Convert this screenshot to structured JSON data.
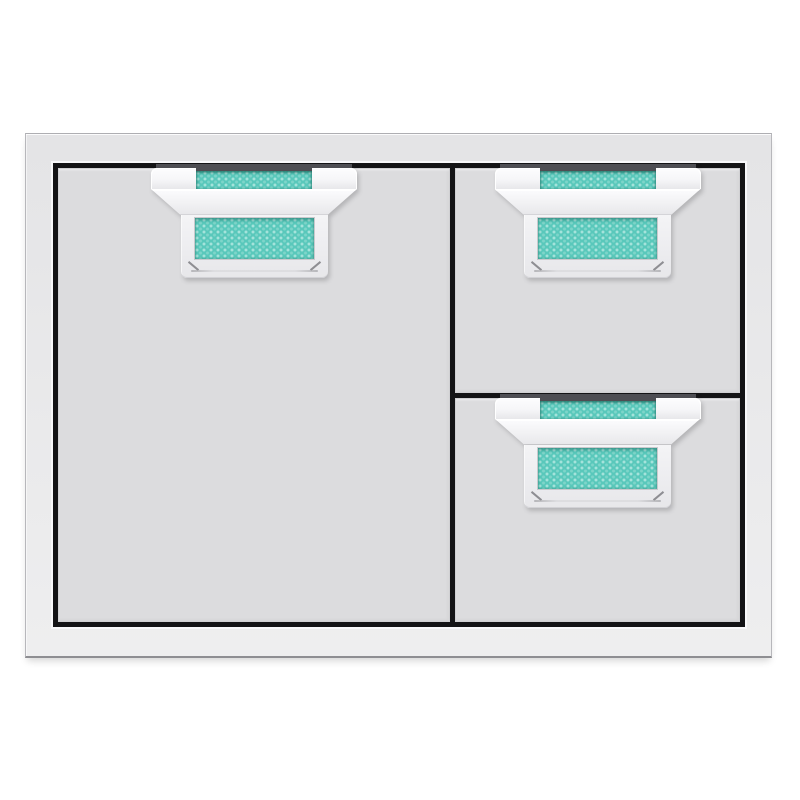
{
  "scene": {
    "subject": "stainless-steel single door and double drawer storage combo with turquoise accent handles",
    "background": "plain white studio background"
  },
  "unit": {
    "frame": "stainless-steel-surround",
    "panels": [
      {
        "id": "access-door",
        "type": "door",
        "position": "left",
        "handle": "turquoise-accent-handle"
      },
      {
        "id": "top-drawer",
        "type": "drawer",
        "position": "right-top",
        "handle": "turquoise-accent-handle"
      },
      {
        "id": "bottom-drawer",
        "type": "drawer",
        "position": "right-bottom",
        "handle": "turquoise-accent-handle"
      }
    ]
  },
  "colors": {
    "background": "#ffffff",
    "frame_face": "#e4e4e6",
    "frame_face_light": "#eeeeef",
    "frame_edge": "#b7b7bb",
    "frame_edge_dark": "#8e8e92",
    "border_black": "#141416",
    "panel_face": "#dcdcde",
    "panel_edge": "#d0d0d3",
    "handle_white": "#f6f6f8",
    "handle_white_deep": "#e7e7ea",
    "mount_gray": "#4e4e53",
    "accent_teal": "#59c8bb",
    "accent_teal_dot": "#a5e3db",
    "accent_teal_dot2": "#7ed5c9",
    "accent_teal_dark": "#2f9e92",
    "bevel_line": "#77777c"
  }
}
